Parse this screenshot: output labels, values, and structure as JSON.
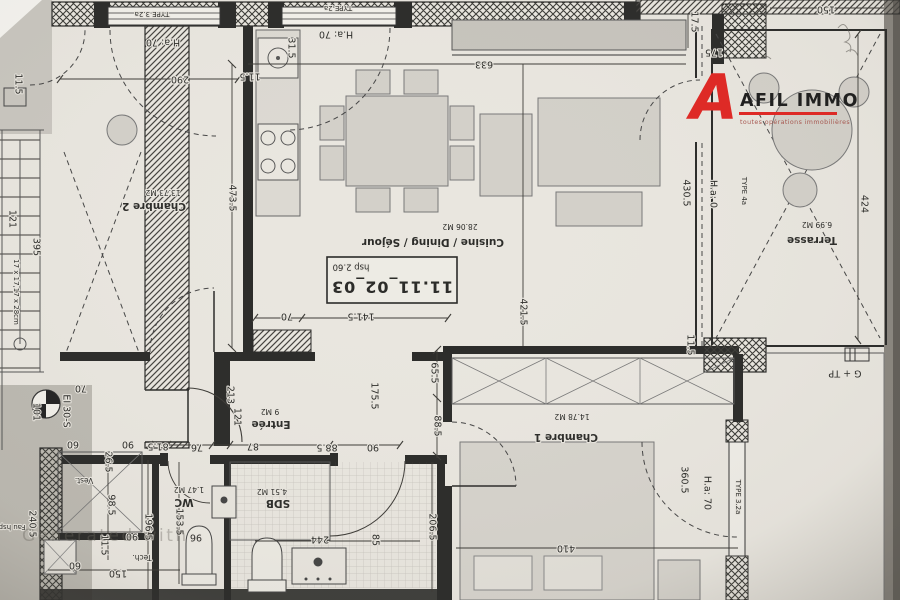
{
  "logo": {
    "mark": "A",
    "brand": "AFIL IMMO",
    "tagline": "toutes opérations immobilières",
    "accent": "#e02622"
  },
  "watermark": "Generated with",
  "unit": {
    "ref": "11.11_02_03",
    "ceiling_height": "hsp 2.60"
  },
  "rooms": {
    "chambre2": {
      "name": "Chambre 2",
      "area": "13.73 M2"
    },
    "cuisine": {
      "name": "Cuisine / Dining / Séjour",
      "area": "28.06 M2"
    },
    "terrasse": {
      "name": "Terrasse",
      "area": "6.99 M2"
    },
    "chambre1": {
      "name": "Chambre 1",
      "area": "14.78 M2"
    },
    "entree": {
      "name": "Entrée",
      "area": "9 M2"
    },
    "sdb": {
      "name": "SDB",
      "area": "4.51 M2"
    },
    "wc": {
      "name": "WC",
      "area": "1.47 M2"
    },
    "vest": {
      "name": "Vest."
    },
    "tech": {
      "name": "Tech."
    },
    "fau": {
      "name": "Fau hsp"
    }
  },
  "dims": [
    "290",
    "473.5",
    "H.a: 70",
    "TYPE 3.2a",
    "TYPE 2a",
    "H.a: 70",
    "31.5",
    "11.5",
    "633",
    "17.5",
    "175",
    "150",
    "424",
    "430.5",
    "H.a: 0",
    "TYPE 4a",
    "421.5",
    "11.5",
    "141.5",
    "70",
    "175.5",
    "65.5",
    "88.5",
    "213",
    "121",
    "81.5",
    "76",
    "87",
    "88.5",
    "90",
    "26.5",
    "98.5",
    "11.5",
    "90",
    "196.5",
    "153.5",
    "96",
    "244",
    "85",
    "206.5",
    "410",
    "360.5",
    "H.a: 70",
    "TYPE 3.2a",
    "G + TP",
    "240.5",
    "150",
    "60",
    "90",
    "60",
    "395",
    "17 x 17,17 x 28cm",
    "121",
    "101",
    "EI 30-S",
    "70",
    "11.5"
  ]
}
